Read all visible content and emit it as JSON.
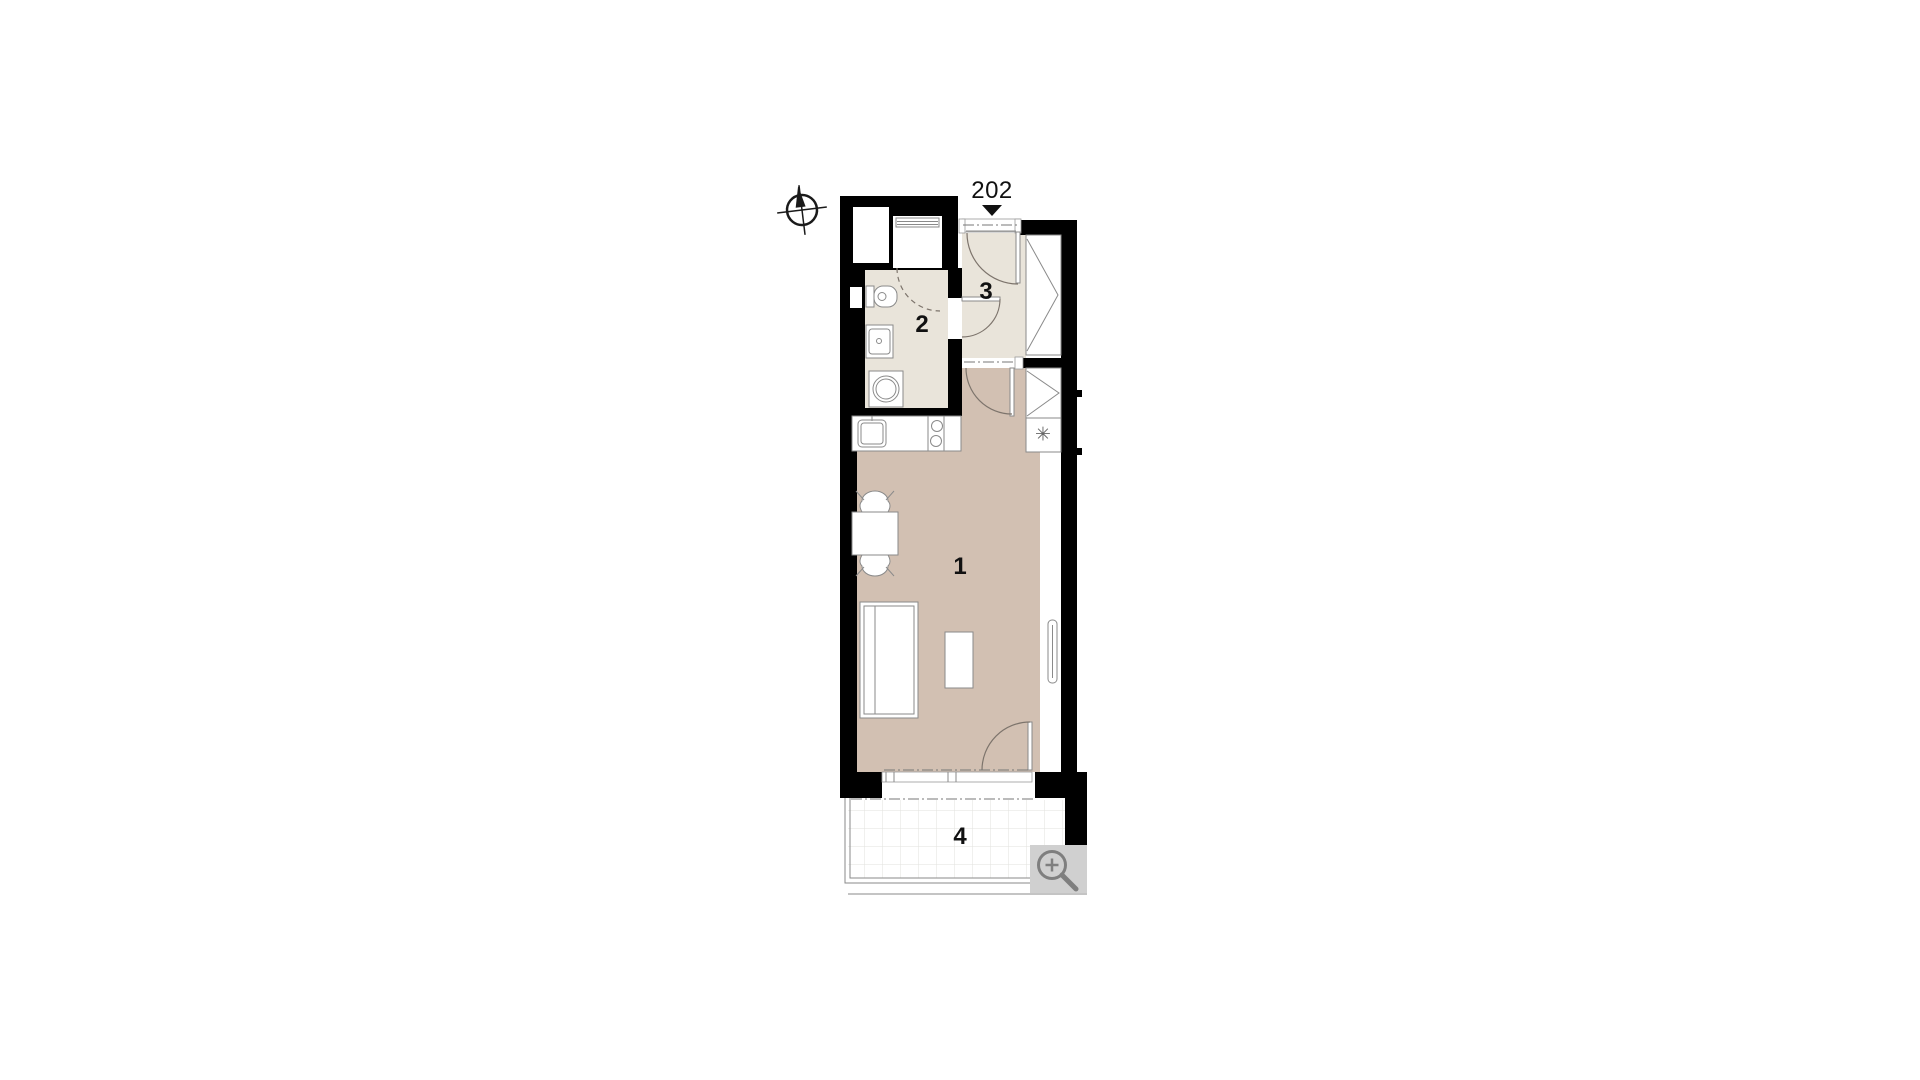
{
  "unit": {
    "number": "202"
  },
  "rooms": [
    {
      "label": "1",
      "name": "main-living-room"
    },
    {
      "label": "2",
      "name": "bathroom"
    },
    {
      "label": "3",
      "name": "entrance-hall"
    },
    {
      "label": "4",
      "name": "terrace"
    }
  ],
  "symbols": {
    "flue": "✳"
  },
  "icons": {
    "compass": "north-arrow-compass-icon",
    "entry_marker": "entry-direction-triangle",
    "zoom": "magnifier-plus-icon"
  },
  "colors": {
    "wall": "#000000",
    "wet_floor": "#e9e4da",
    "room_floor": "#d2c0b2",
    "terrace_grid": "#e2e2de",
    "furniture_line": "#8a8a8a",
    "door_line": "#7d746c",
    "zoom_button_bg": "#d0d0d0",
    "zoom_icon": "#7f7f7f",
    "label_text": "#111111"
  }
}
